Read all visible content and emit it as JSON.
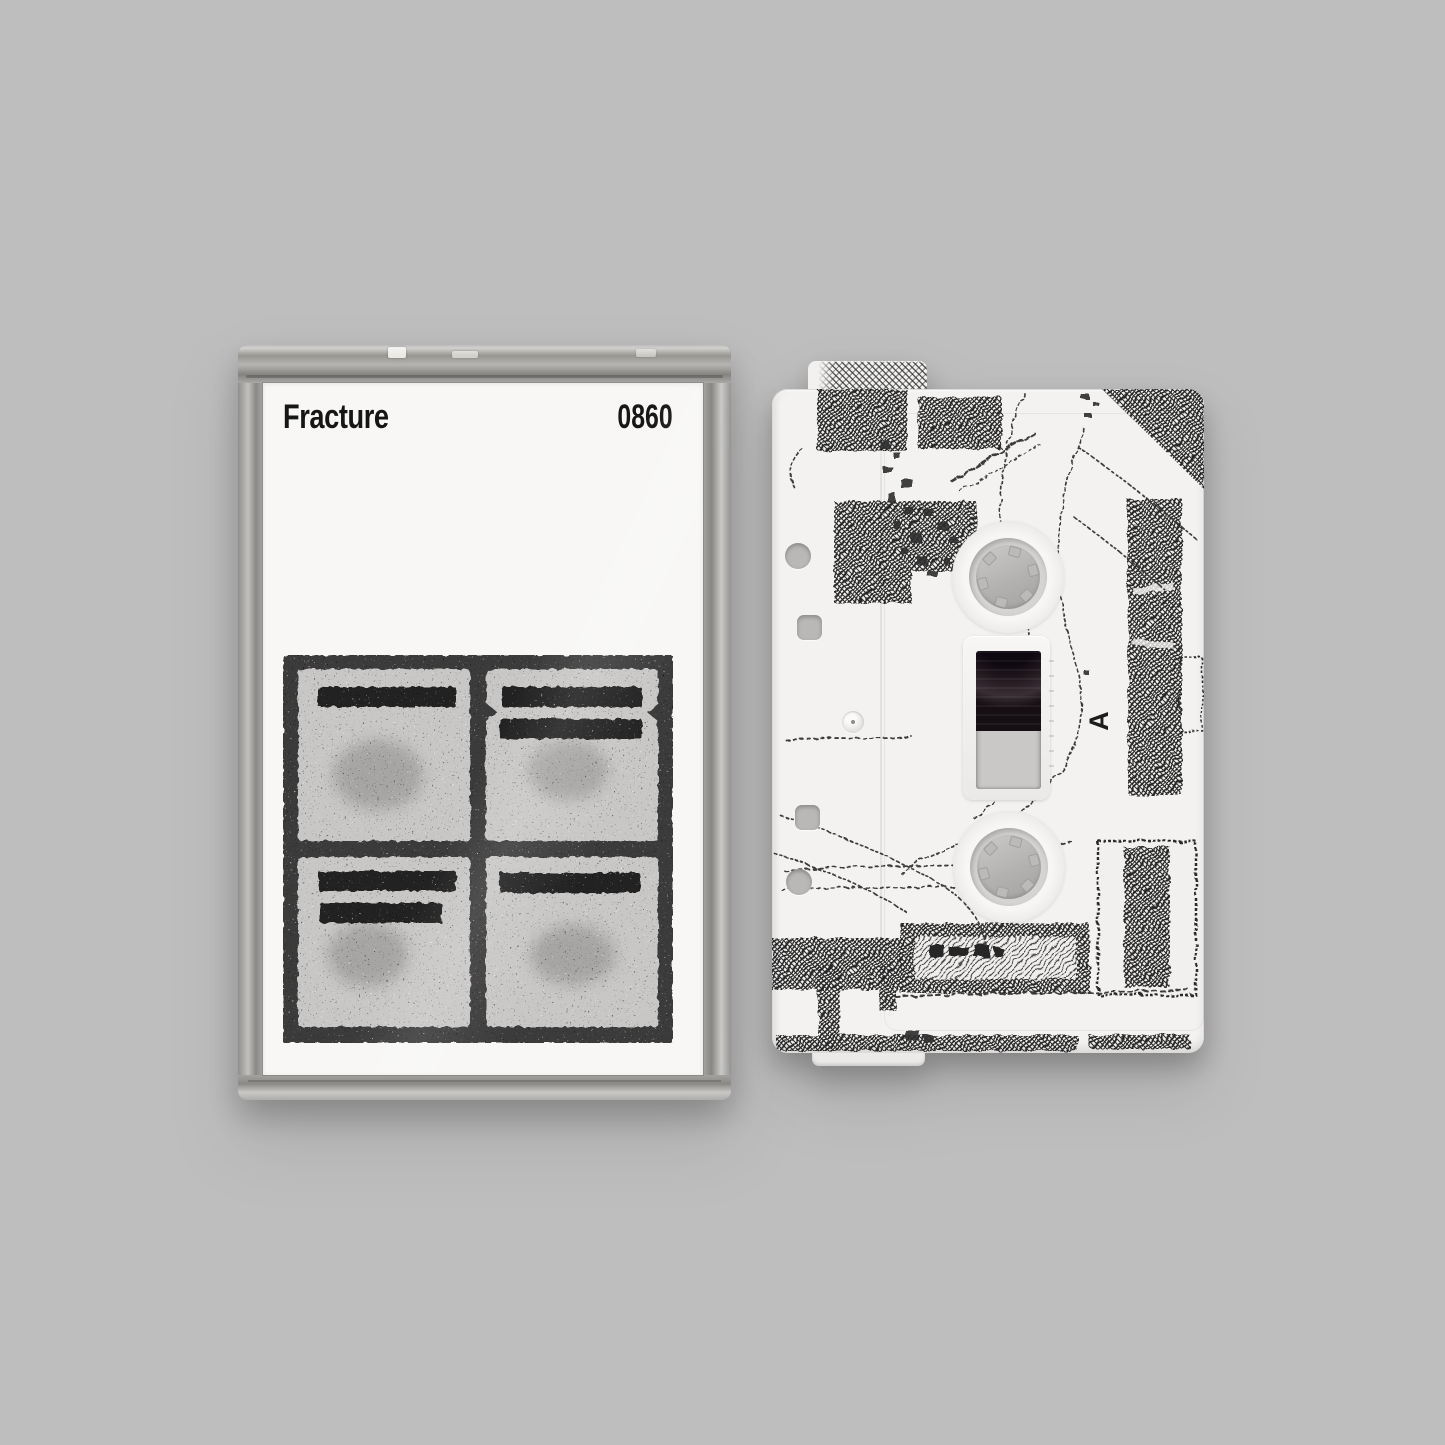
{
  "scene": {
    "background": "#bfbebe"
  },
  "case": {
    "artist": "Fracture",
    "catalog": "0860",
    "colors": {
      "card": "#f8f7f5",
      "frame_plastic": "#a5a4a2",
      "art_dark": "#3a3a3a",
      "art_light": "#c8c7c5",
      "art_bars": "#242424"
    }
  },
  "tape": {
    "side_label": "A",
    "colors": {
      "shell": "#f3f2f0",
      "hub": "#b3b2b0",
      "tape_reel": "#1f171d",
      "print_ink": "#2c2c2c"
    }
  }
}
